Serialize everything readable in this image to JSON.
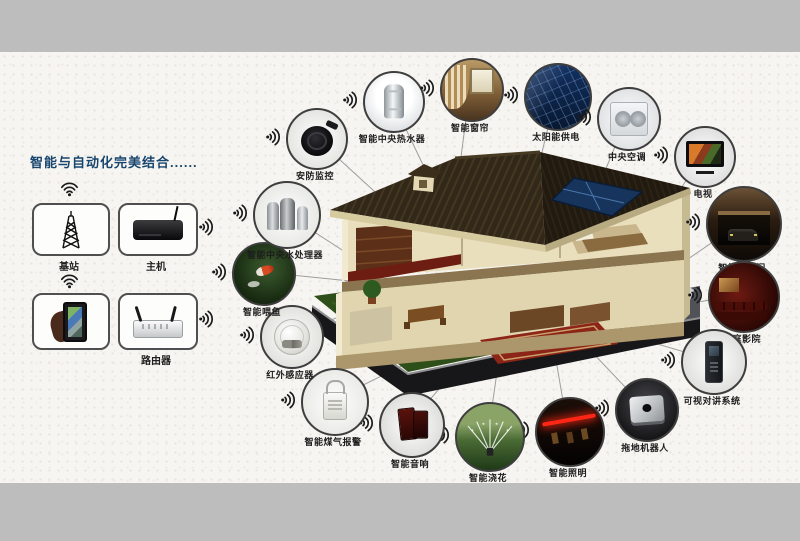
{
  "left_panel": {
    "title": "智能与自动化完美结合......",
    "items": [
      {
        "id": "base-station",
        "label": "基站",
        "icon": "signal-tower-icon"
      },
      {
        "id": "host",
        "label": "主机",
        "icon": "set-top-box-icon"
      },
      {
        "id": "smartphone",
        "label": "",
        "icon": "smartphone-hand-icon"
      },
      {
        "id": "router",
        "label": "路由器",
        "icon": "router-icon"
      }
    ]
  },
  "nodes": [
    {
      "id": "water-heater",
      "label": "智能中央热水器",
      "icon": "water-heater-icon"
    },
    {
      "id": "curtain",
      "label": "智能窗帘",
      "icon": "curtain-icon"
    },
    {
      "id": "solar-power",
      "label": "太阳能供电",
      "icon": "solar-panel-icon"
    },
    {
      "id": "central-ac",
      "label": "中央空调",
      "icon": "air-conditioner-icon"
    },
    {
      "id": "tv",
      "label": "电视",
      "icon": "tv-icon"
    },
    {
      "id": "garage-door",
      "label": "智能车库门",
      "icon": "garage-door-icon"
    },
    {
      "id": "home-theater",
      "label": "家庭影院",
      "icon": "home-theater-icon"
    },
    {
      "id": "video-intercom",
      "label": "可视对讲系统",
      "icon": "intercom-icon"
    },
    {
      "id": "mopping-robot",
      "label": "拖地机器人",
      "icon": "mopping-robot-icon"
    },
    {
      "id": "lighting",
      "label": "智能照明",
      "icon": "lighting-icon"
    },
    {
      "id": "watering",
      "label": "智能浇花",
      "icon": "sprinkler-icon"
    },
    {
      "id": "speaker",
      "label": "智能音响",
      "icon": "speaker-icon"
    },
    {
      "id": "gas-alarm",
      "label": "智能煤气报警",
      "icon": "gas-alarm-icon"
    },
    {
      "id": "infrared-sensor",
      "label": "红外感应器",
      "icon": "infrared-sensor-icon"
    },
    {
      "id": "fish-feeder",
      "label": "智能喂鱼",
      "icon": "fish-feeder-icon"
    },
    {
      "id": "water-processor",
      "label": "智能中央水处理器",
      "icon": "water-processor-icon"
    },
    {
      "id": "security-monitor",
      "label": "安防监控",
      "icon": "security-camera-icon"
    }
  ],
  "colors": {
    "title_blue": "#17456e",
    "band_gray": "#bdbdbd",
    "paper": "#f7f5f1",
    "circle_ring": "#3e3e3e",
    "connector": "#9e9e9e",
    "roof_brown": "#32281a",
    "grass_green": "#2f4f1a",
    "solar_blue": "#16345c"
  }
}
